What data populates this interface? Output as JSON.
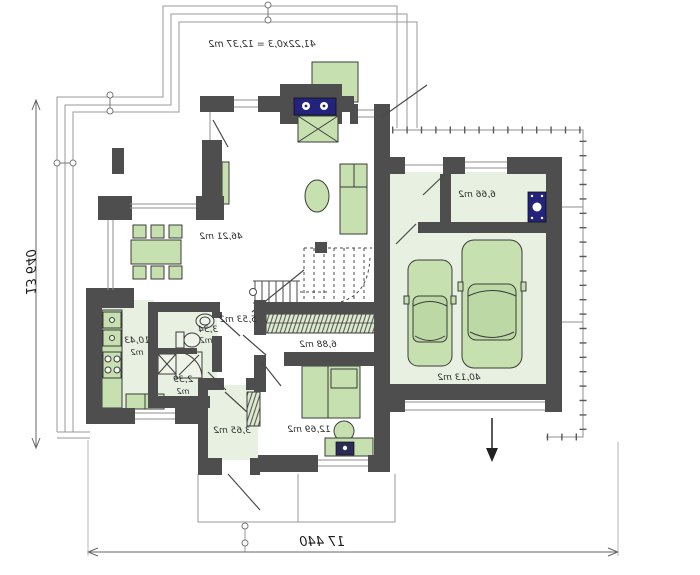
{
  "drawing": {
    "title": "floor-plan-ground-floor",
    "total_width": "17 440",
    "total_height": "13 640",
    "terrace_note": "41,22x0,3 = 12,37 m2"
  },
  "rooms": {
    "living": {
      "area": "46,21 m2"
    },
    "kitchen": {
      "value": "10,43",
      "unit": "m2"
    },
    "bathroom": {
      "value": "3,34",
      "unit": "m2"
    },
    "wc": {
      "value": "2,39",
      "unit": "m2"
    },
    "hall": {
      "area": "5,53 m2"
    },
    "wardrobe": {
      "area": "6,88 m2"
    },
    "vestibule": {
      "area": "3,65 m2"
    },
    "bedroom": {
      "area": "12,69 m2"
    },
    "garage": {
      "area": "40,13 m2"
    },
    "technical": {
      "area": "6,66 m2"
    }
  },
  "colors": {
    "wall": "#4e4e4e",
    "floor_green": "#e8f1e1",
    "furniture_green": "#c6e0b0",
    "navy_fixture": "#23237d",
    "thin_line": "#979797",
    "dim_line": "#666666"
  }
}
